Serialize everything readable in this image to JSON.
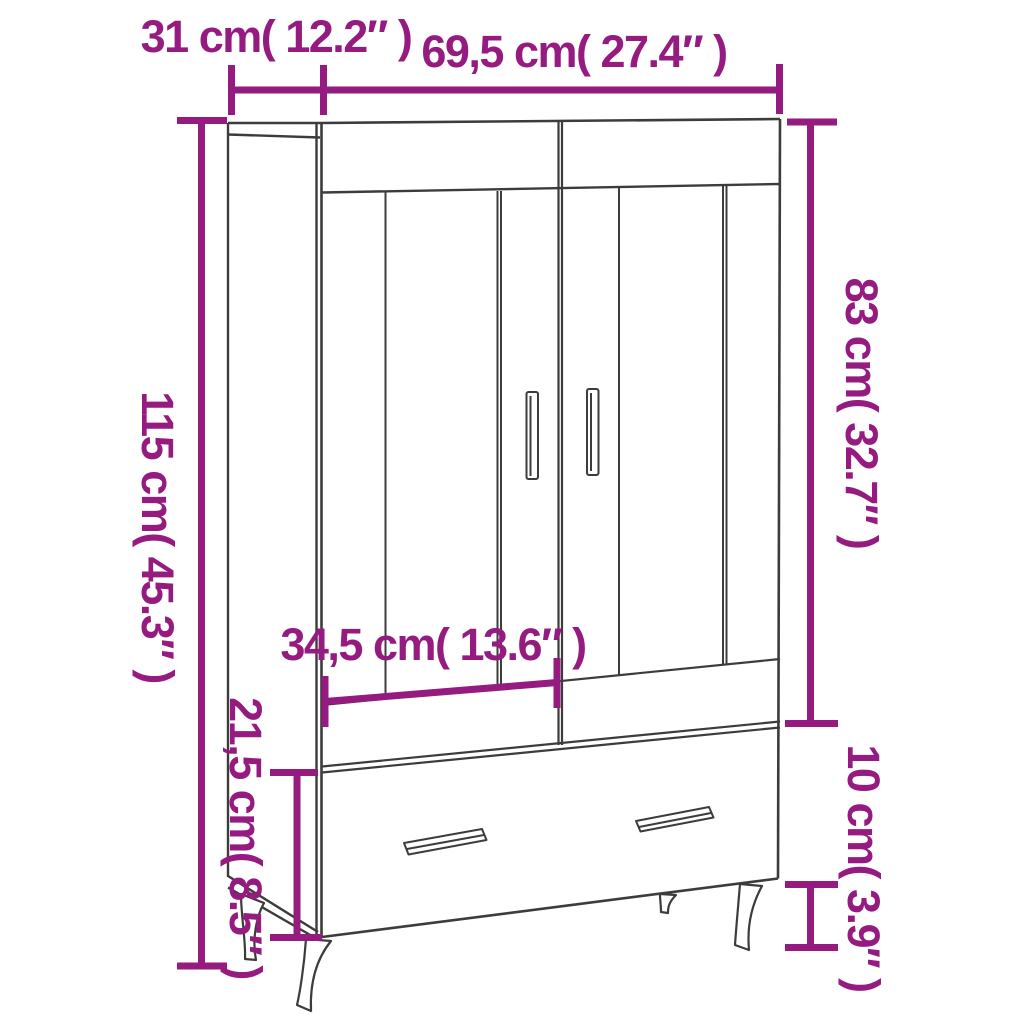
{
  "diagram": {
    "figure": "highboard-cabinet-line-drawing",
    "background": "#ffffff",
    "accent_color": "#951b81",
    "outline_color": "#3c3c3b",
    "dims": {
      "depth": {
        "label": "31 cm( 12.2″ )",
        "cm": "31",
        "in": "12.2"
      },
      "width": {
        "label": "69,5 cm( 27.4″ )",
        "cm": "69,5",
        "in": "27.4"
      },
      "total_height": {
        "label": "115 cm( 45.3″ )",
        "cm": "115",
        "in": "45.3"
      },
      "upper_height": {
        "label": "83 cm( 32.7″ )",
        "cm": "83",
        "in": "32.7"
      },
      "door_width": {
        "label": "34,5 cm( 13.6″ )",
        "cm": "34,5",
        "in": "13.6"
      },
      "drawer_height": {
        "label": "21,5 cm( 8.5″ )",
        "cm": "21,5",
        "in": "8.5"
      },
      "leg_height": {
        "label": "10 cm( 3.9″ )",
        "cm": "10",
        "in": "3.9"
      }
    }
  }
}
